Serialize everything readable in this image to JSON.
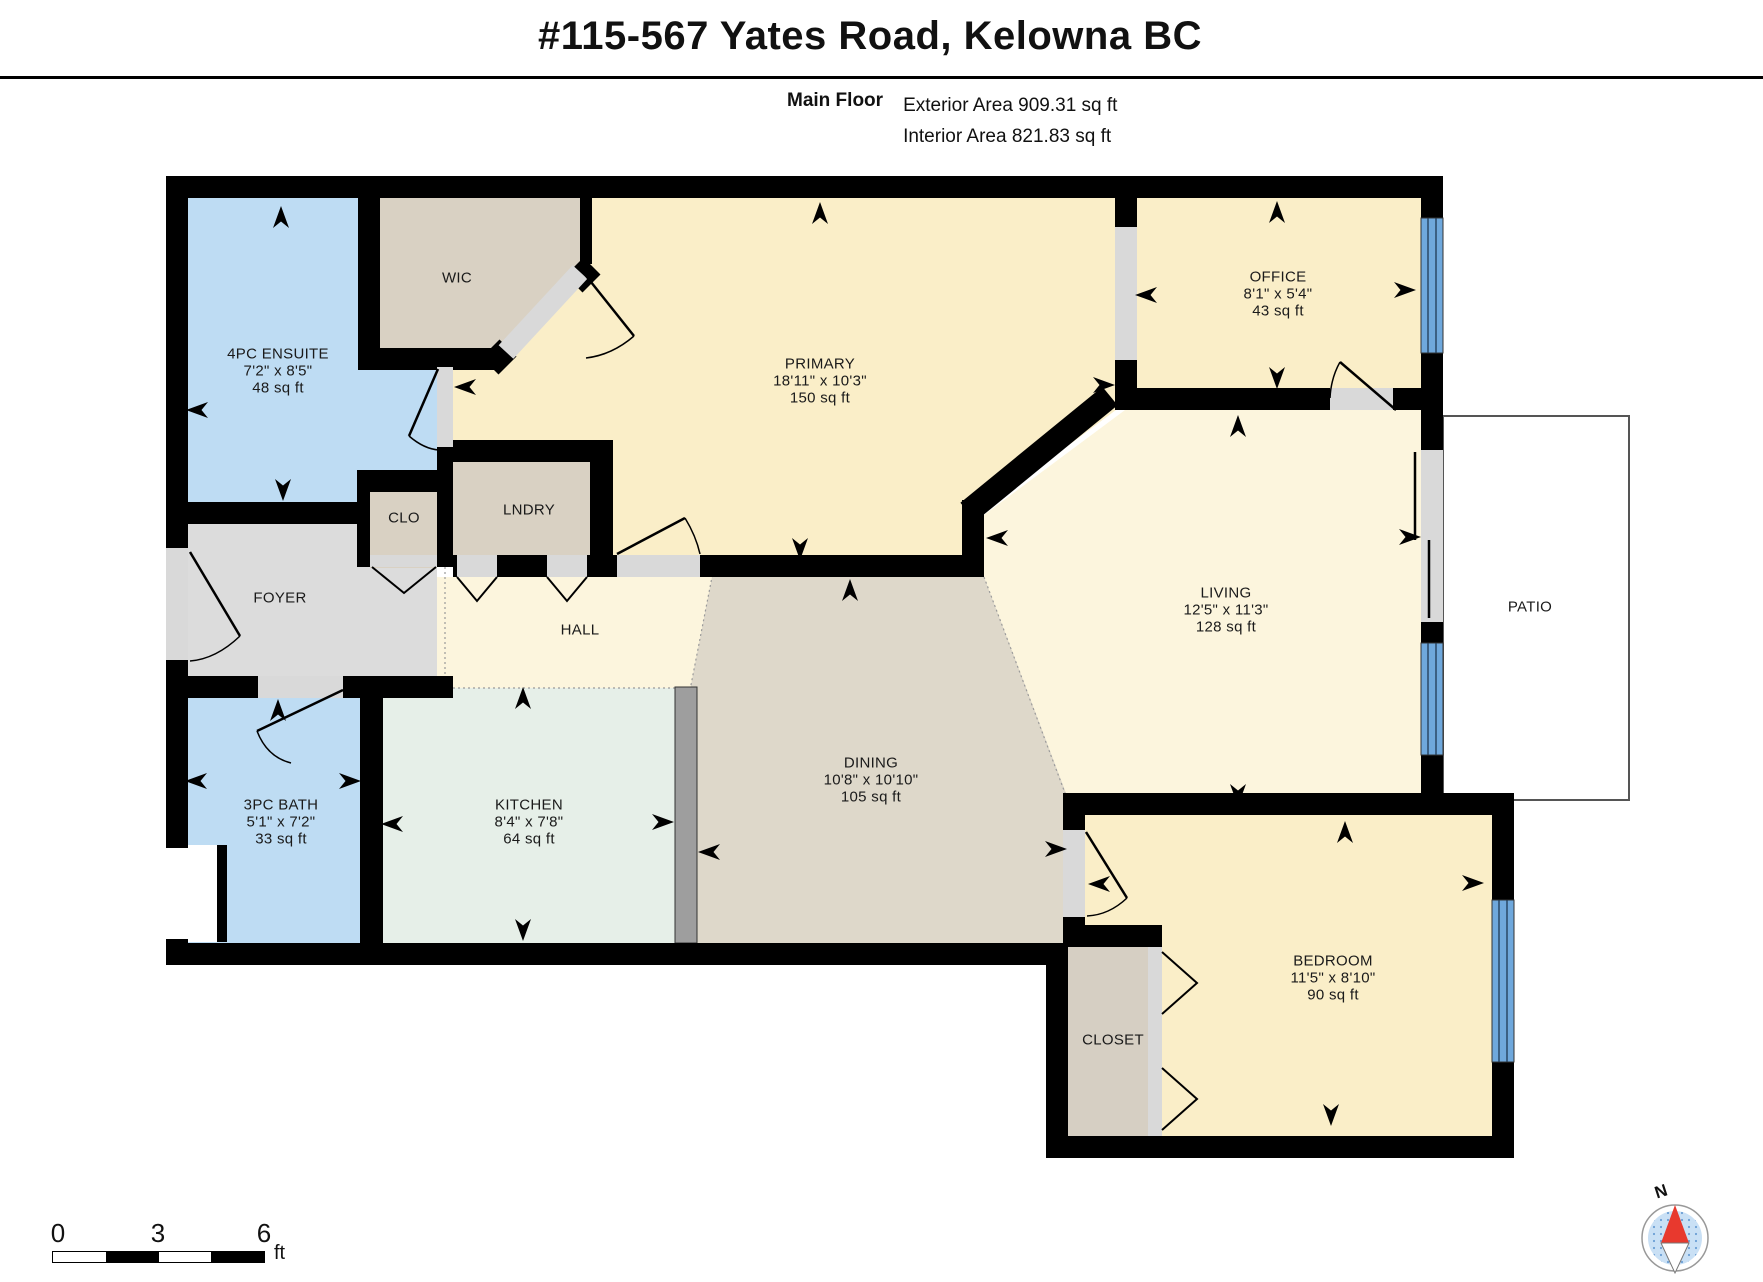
{
  "header": {
    "title": "#115-567 Yates Road, Kelowna BC",
    "floor_label": "Main Floor",
    "exterior_area": "Exterior Area 909.31 sq ft",
    "interior_area": "Interior Area 821.83 sq ft"
  },
  "rooms": {
    "ensuite": {
      "name": "4PC ENSUITE",
      "dims": "7'2\" x 8'5\"",
      "area": "48 sq ft"
    },
    "wic": {
      "name": "WIC"
    },
    "primary": {
      "name": "PRIMARY",
      "dims": "18'11\" x 10'3\"",
      "area": "150 sq ft"
    },
    "office": {
      "name": "OFFICE",
      "dims": "8'1\" x 5'4\"",
      "area": "43 sq ft"
    },
    "living": {
      "name": "LIVING",
      "dims": "12'5\" x 11'3\"",
      "area": "128 sq ft"
    },
    "patio": {
      "name": "PATIO"
    },
    "foyer": {
      "name": "FOYER"
    },
    "clo": {
      "name": "CLO"
    },
    "lndry": {
      "name": "LNDRY"
    },
    "hall": {
      "name": "HALL"
    },
    "bath": {
      "name": "3PC BATH",
      "dims": "5'1\" x 7'2\"",
      "area": "33 sq ft"
    },
    "kitchen": {
      "name": "KITCHEN",
      "dims": "8'4\" x 7'8\"",
      "area": "64 sq ft"
    },
    "dining": {
      "name": "DINING",
      "dims": "10'8\" x 10'10\"",
      "area": "105 sq ft"
    },
    "bedroom": {
      "name": "BEDROOM",
      "dims": "11'5\" x 8'10\"",
      "area": "90 sq ft"
    },
    "closet": {
      "name": "CLOSET"
    }
  },
  "scale_bar": {
    "start_label": "0",
    "mid_label": "3",
    "end_label": "6",
    "unit_label": "ft"
  },
  "compass": {
    "north_label": "N"
  },
  "colors": {
    "wall_black": "#000000",
    "bath_blue": "#bedcf3",
    "bedroom_yellow": "#faeec8",
    "living_cream": "#fcf5dd",
    "closet_tan": "#d9d1c3",
    "foyer_gray": "#dcdcdc",
    "kitchen_mint": "#e6efe8",
    "dining_greige": "#ded8ca",
    "window_blue": "#6fa8dc",
    "opening_gray": "#d9d9d9",
    "counter_gray": "#9e9e9e",
    "compass_red": "#e8392e",
    "compass_blue": "#c9e0f5"
  }
}
